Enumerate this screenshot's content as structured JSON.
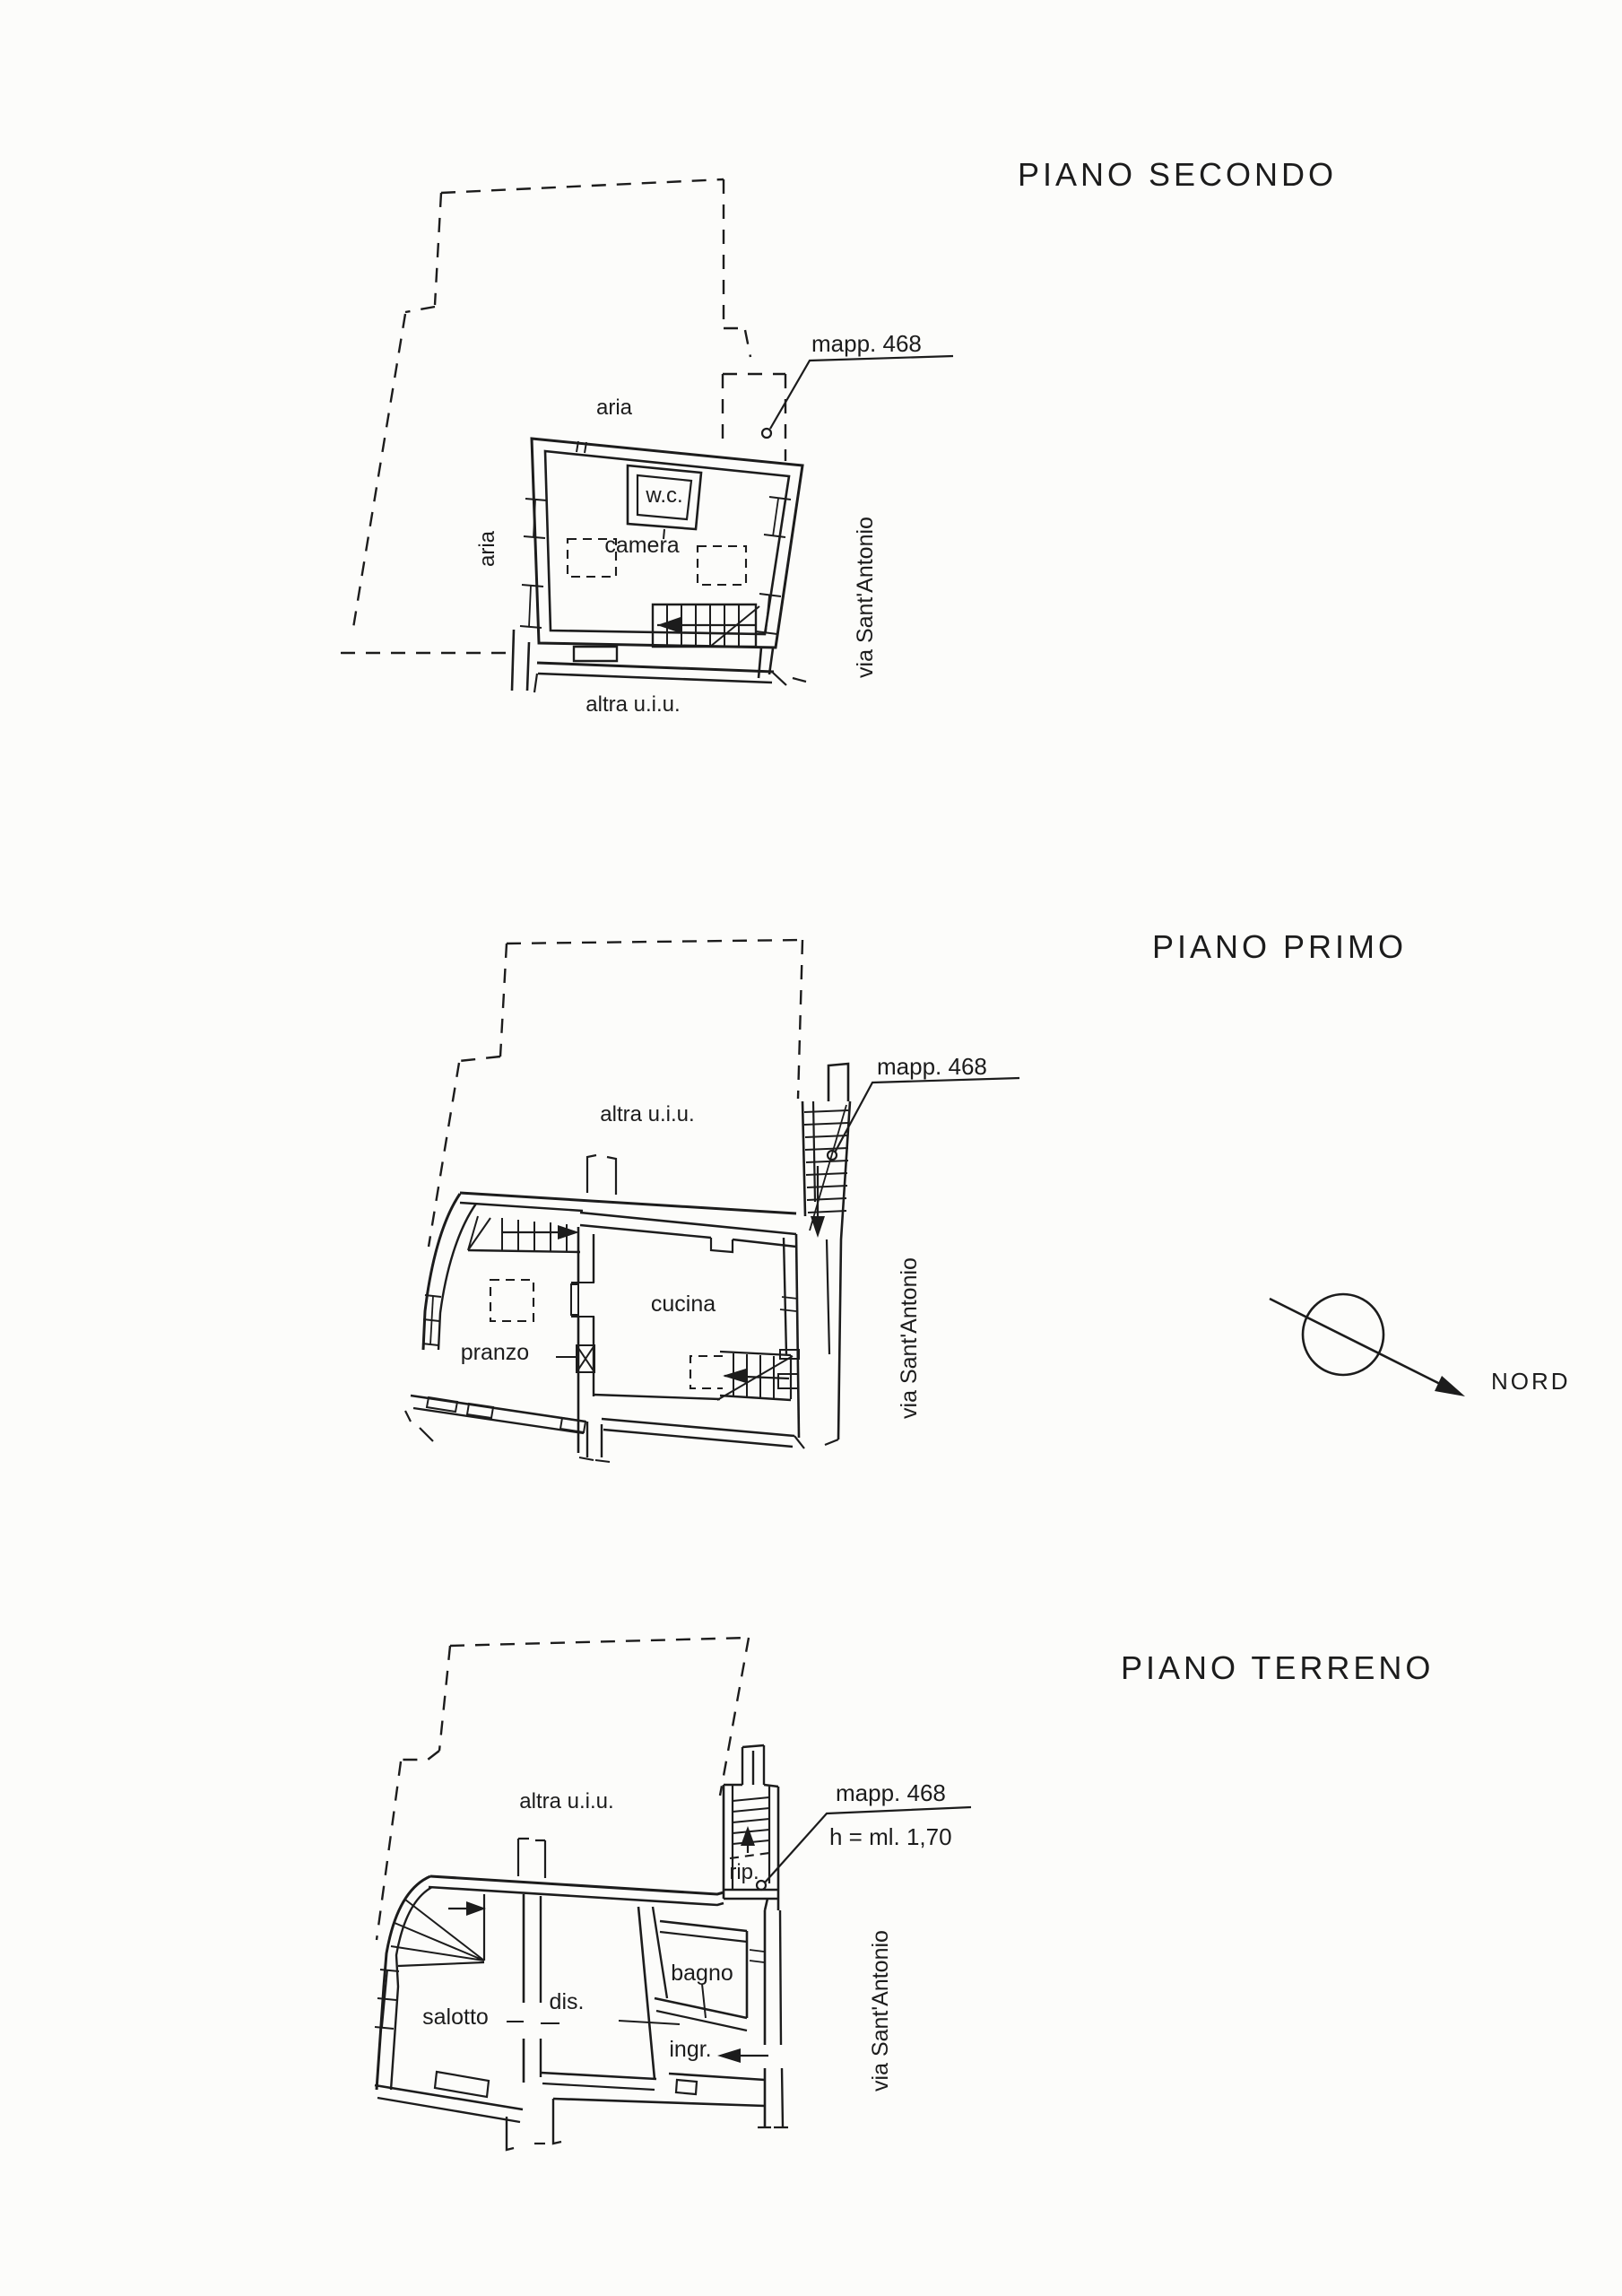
{
  "colors": {
    "paper": "#fcfcfa",
    "ink": "#1c1c1c"
  },
  "floors": {
    "secondo": {
      "title": "PIANO SECONDO",
      "mapp": "mapp. 468",
      "aria_top": "aria",
      "aria_left": "aria",
      "wc": "w.c.",
      "camera": "camera",
      "altra_uiu": "altra u.i.u.",
      "street": "via Sant'Antonio"
    },
    "primo": {
      "title": "PIANO PRIMO",
      "mapp": "mapp. 468",
      "altra_uiu": "altra u.i.u.",
      "pranzo": "pranzo",
      "cucina": "cucina",
      "street": "via Sant'Antonio"
    },
    "terreno": {
      "title": "PIANO TERRENO",
      "mapp": "mapp. 468",
      "height_note": "h = ml. 1,70",
      "altra_uiu": "altra u.i.u.",
      "rip": "rip.",
      "salotto": "salotto",
      "dis": "dis.",
      "bagno": "bagno",
      "ingr": "ingr.",
      "street": "via Sant'Antonio"
    }
  },
  "compass": {
    "north": "NORD"
  }
}
